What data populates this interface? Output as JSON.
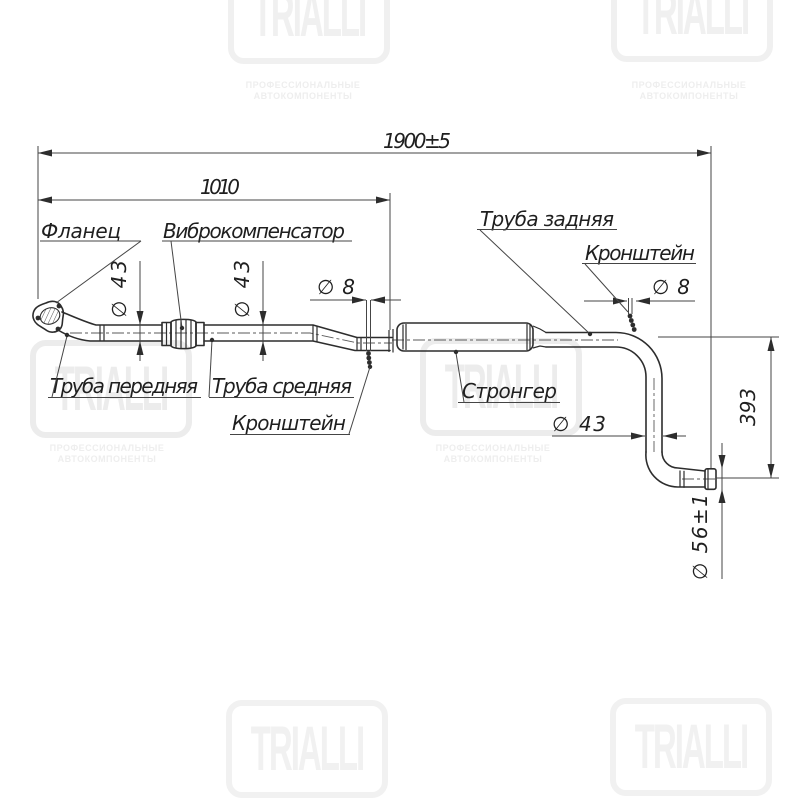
{
  "drawing_type": "exhaust-system-technical-drawing",
  "labels": {
    "flanec": "Фланец",
    "vibro": "Виброкомпенсатор",
    "truba_zadnyaya": "Труба задняя",
    "kronshtein": "Кронштейн",
    "truba_perednyaya": "Труба передняя",
    "truba_srednyaya": "Труба средняя",
    "stronger": "Стронгер"
  },
  "dimensions": {
    "overall": "1900±5",
    "front": "1010",
    "d43": "∅ 43",
    "d8": "∅ 8",
    "height": "393",
    "d56": "∅ 56±1"
  },
  "watermark": {
    "brand": "TRIALLI",
    "tagline1": "ПРОФЕССИОНАЛЬНЫЕ",
    "tagline2": "АВТОКОМПОНЕНТЫ"
  }
}
